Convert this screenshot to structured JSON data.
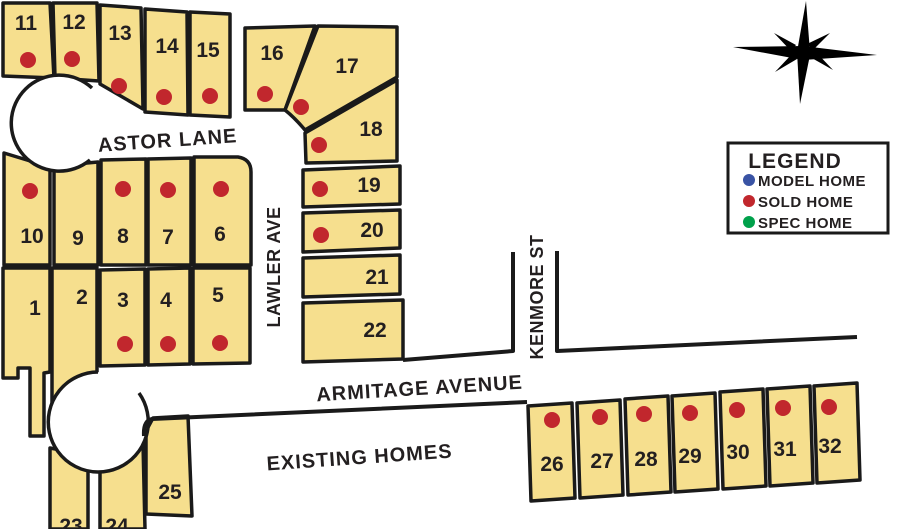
{
  "streets": {
    "astor": "ASTOR LANE",
    "lawler": "LAWLER AVE",
    "kenmore": "KENMORE ST",
    "armitage": "ARMITAGE AVENUE",
    "existing": "EXISTING HOMES"
  },
  "legend": {
    "title": "LEGEND",
    "items": [
      {
        "label": "MODEL HOME",
        "color": "#3953a4"
      },
      {
        "label": "SOLD HOME",
        "color": "#c1272d"
      },
      {
        "label": "SPEC HOME",
        "color": "#00a14b"
      }
    ]
  },
  "colors": {
    "lot_fill": "#f6df8e",
    "outline": "#1a1a1a"
  },
  "lots": [
    {
      "number": "1",
      "sold": false
    },
    {
      "number": "2",
      "sold": false
    },
    {
      "number": "3",
      "sold": true
    },
    {
      "number": "4",
      "sold": true
    },
    {
      "number": "5",
      "sold": true
    },
    {
      "number": "6",
      "sold": true
    },
    {
      "number": "7",
      "sold": true
    },
    {
      "number": "8",
      "sold": true
    },
    {
      "number": "9",
      "sold": false
    },
    {
      "number": "10",
      "sold": true
    },
    {
      "number": "11",
      "sold": true
    },
    {
      "number": "12",
      "sold": true
    },
    {
      "number": "13",
      "sold": true
    },
    {
      "number": "14",
      "sold": true
    },
    {
      "number": "15",
      "sold": true
    },
    {
      "number": "16",
      "sold": true
    },
    {
      "number": "17",
      "sold": true
    },
    {
      "number": "18",
      "sold": true
    },
    {
      "number": "19",
      "sold": true
    },
    {
      "number": "20",
      "sold": true
    },
    {
      "number": "21",
      "sold": false
    },
    {
      "number": "22",
      "sold": false
    },
    {
      "number": "23",
      "sold": false
    },
    {
      "number": "24",
      "sold": false
    },
    {
      "number": "25",
      "sold": false
    },
    {
      "number": "26",
      "sold": true
    },
    {
      "number": "27",
      "sold": true
    },
    {
      "number": "28",
      "sold": true
    },
    {
      "number": "29",
      "sold": true
    },
    {
      "number": "30",
      "sold": true
    },
    {
      "number": "31",
      "sold": true
    },
    {
      "number": "32",
      "sold": true
    }
  ]
}
